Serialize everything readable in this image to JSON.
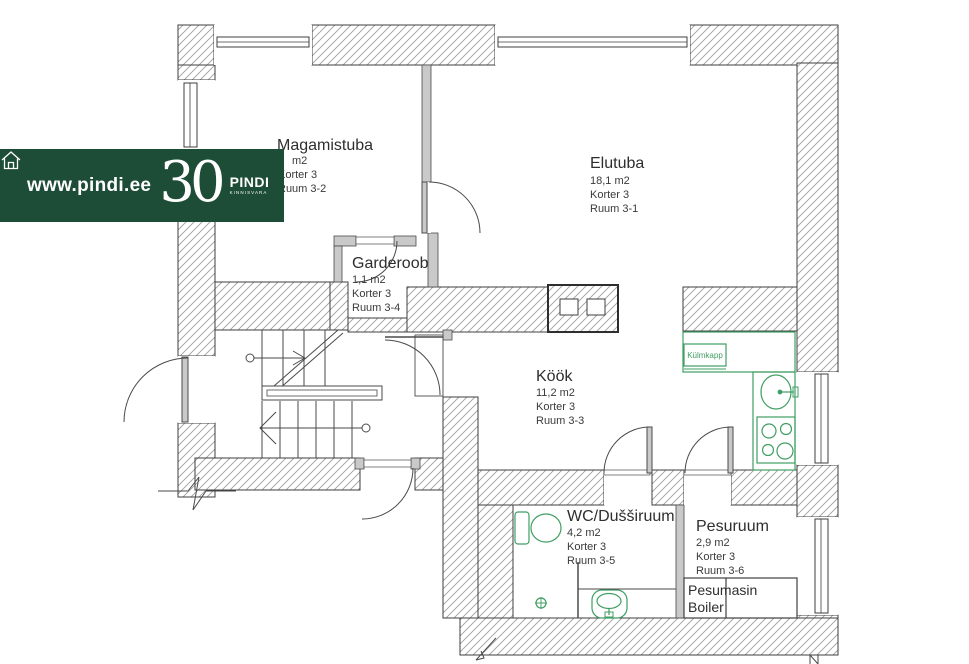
{
  "banner": {
    "url": "www.pindi.ee",
    "anniversary": "30",
    "brand": "PINDI",
    "brand_sub": "KINNISVARA"
  },
  "rooms": {
    "magamistuba": {
      "name": "Magamistuba",
      "area": "m2",
      "korter": "Korter 3",
      "ruum": "Ruum 3-2"
    },
    "elutuba": {
      "name": "Elutuba",
      "area": "18,1 m2",
      "korter": "Korter 3",
      "ruum": "Ruum 3-1"
    },
    "garderoob": {
      "name": "Garderoob",
      "area": "1,1 m2",
      "korter": "Korter 3",
      "ruum": "Ruum 3-4"
    },
    "kook": {
      "name": "Köök",
      "area": "11,2 m2",
      "korter": "Korter 3",
      "ruum": "Ruum 3-3"
    },
    "wc": {
      "name": "WC/Dušširuum",
      "area": "4,2 m2",
      "korter": "Korter 3",
      "ruum": "Ruum 3-5"
    },
    "pesuruum": {
      "name": "Pesuruum",
      "area": "2,9 m2",
      "korter": "Korter 3",
      "ruum": "Ruum 3-6"
    }
  },
  "fixtures": {
    "fridge": "Külmkapp",
    "washer": "Pesumasin",
    "boiler": "Boiler"
  },
  "colors": {
    "banner_green": "#1d4d36",
    "fixture_green": "#3f9e63",
    "wall_line": "#3f3f3f",
    "wall_hatch": "#9f9f9f",
    "wall_gray": "#c9c9c9"
  }
}
